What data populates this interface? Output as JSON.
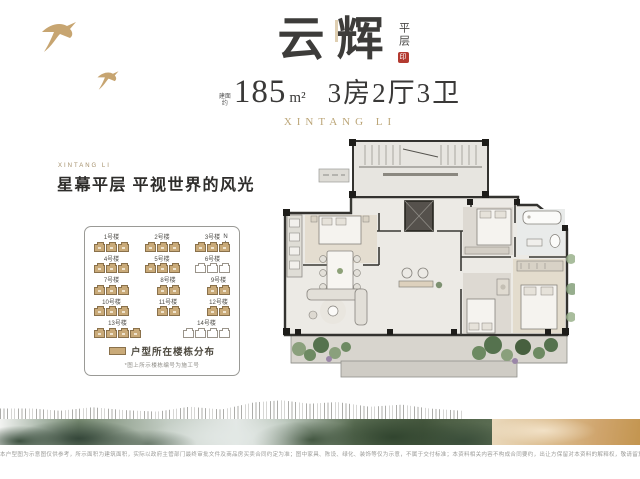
{
  "header": {
    "title": "云辉",
    "title_tag": "平层",
    "seal_text": "印",
    "area_prefix_top": "建面",
    "area_prefix_bottom": "约",
    "area_value": "185",
    "area_unit": "m²",
    "rooms": "3房2厅3卫",
    "brand": "XINTANG LI"
  },
  "left": {
    "eyebrow": "XINTANG LI",
    "headline": "星幕平层 平视世界的风光",
    "sitemap": {
      "compass_label": "N",
      "legend_label": "户型所在楼栋分布",
      "note": "*图上所示楼栋编号为施工号",
      "rows": [
        [
          {
            "label": "1号楼",
            "units": 3,
            "highlight": true
          },
          {
            "label": "2号楼",
            "units": 3,
            "highlight": true
          },
          {
            "label": "3号楼",
            "units": 3,
            "highlight": true
          }
        ],
        [
          {
            "label": "4号楼",
            "units": 3,
            "highlight": true
          },
          {
            "label": "5号楼",
            "units": 3,
            "highlight": true
          },
          {
            "label": "6号楼",
            "units": 3,
            "highlight": false
          }
        ],
        [
          {
            "label": "7号楼",
            "units": 3,
            "highlight": true
          },
          {
            "label": "8号楼",
            "units": 2,
            "highlight": true
          },
          {
            "label": "9号楼",
            "units": 2,
            "highlight": true
          }
        ],
        [
          {
            "label": "10号楼",
            "units": 3,
            "highlight": true
          },
          {
            "label": "11号楼",
            "units": 2,
            "highlight": true
          },
          {
            "label": "12号楼",
            "units": 2,
            "highlight": true
          }
        ],
        [
          {
            "label": "13号楼",
            "units": 4,
            "highlight": true
          },
          {
            "label": "14号楼",
            "units": 4,
            "highlight": false
          }
        ]
      ]
    }
  },
  "colors": {
    "accent_gold": "#bca678",
    "seal_red": "#b33a30",
    "building_fill": "#c9aa79",
    "building_border": "#8a714b"
  },
  "footer": {
    "disclaimer": "本户型图为示意图仅供参考，所示面积为建筑面积，实际以政府主管部门最终审批文件及商品房买卖合同约定为准；图中家具、陈设、绿化、装饰等仅为示意，不属于交付标准；本资料相关内容不构成合同要约，出让方保留对本资料的解释权，敬请留意最新信息。"
  }
}
